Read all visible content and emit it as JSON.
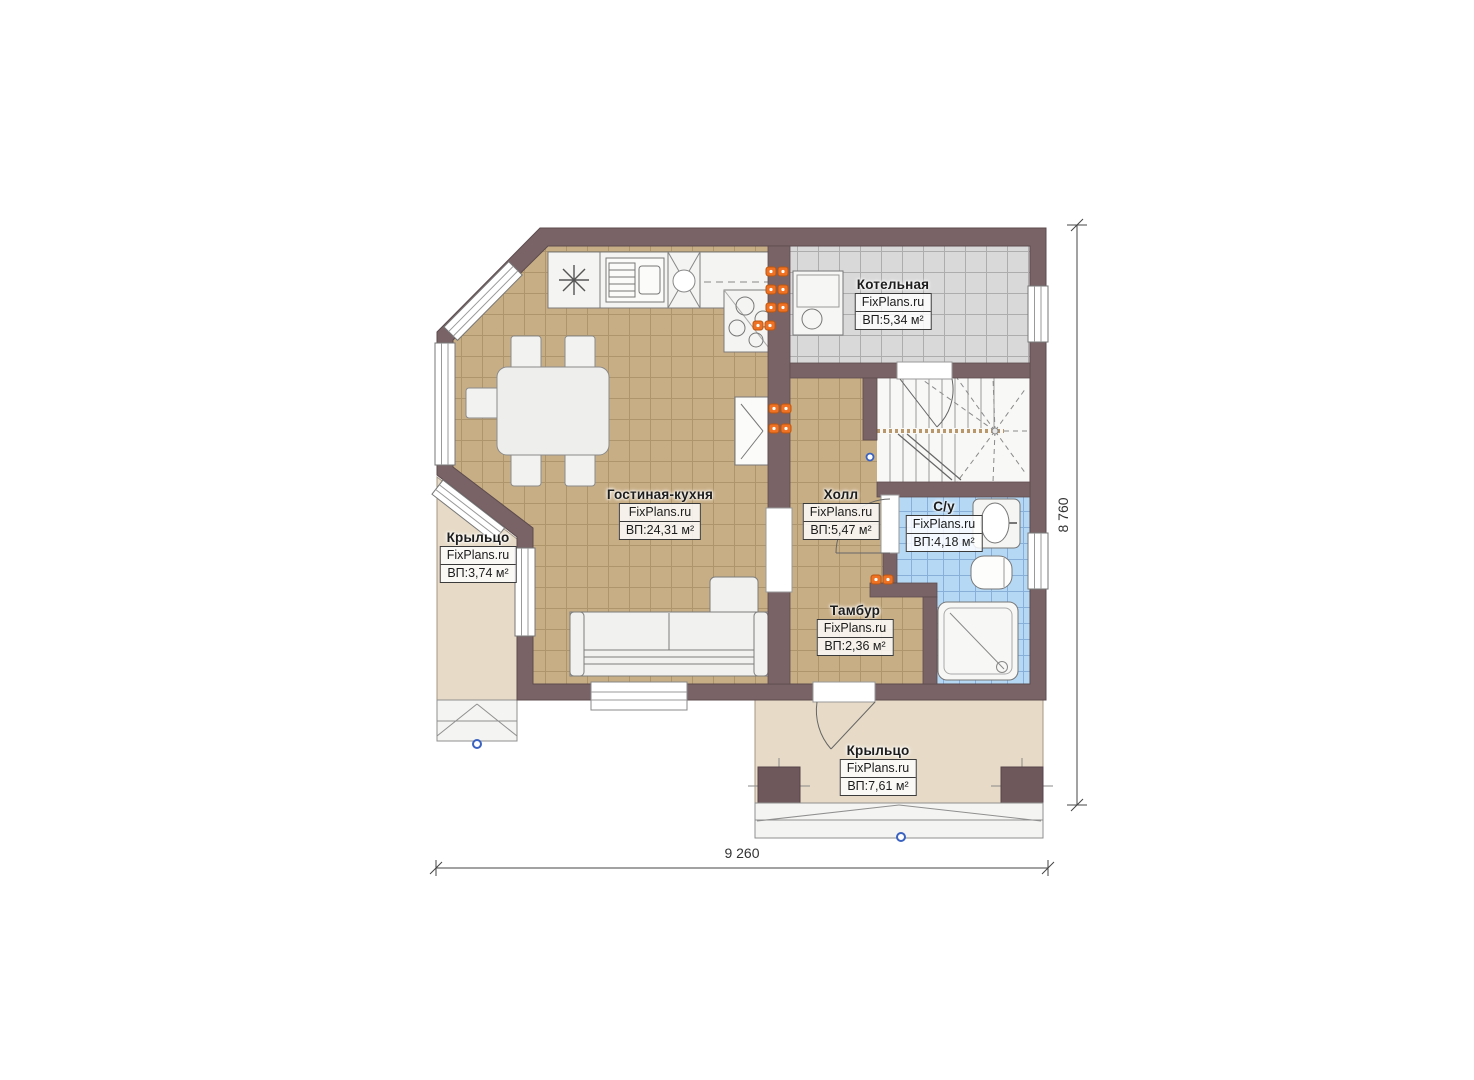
{
  "brand": "FixPlans.ru",
  "rooms": {
    "boiler": {
      "name": "Котельная",
      "brand": "FixPlans.ru",
      "area": "ВП:5,34 м²"
    },
    "living_kitchen": {
      "name": "Гостиная-кухня",
      "brand": "FixPlans.ru",
      "area": "ВП:24,31 м²"
    },
    "hall": {
      "name": "Холл",
      "brand": "FixPlans.ru",
      "area": "ВП:5,47 м²"
    },
    "bathroom": {
      "name": "С/у",
      "brand": "FixPlans.ru",
      "area": "ВП:4,18 м²"
    },
    "vestibule": {
      "name": "Тамбур",
      "brand": "FixPlans.ru",
      "area": "ВП:2,36 м²"
    },
    "porch_left": {
      "name": "Крыльцо",
      "brand": "FixPlans.ru",
      "area": "ВП:3,74 м²"
    },
    "porch_bottom": {
      "name": "Крыльцо",
      "brand": "FixPlans.ru",
      "area": "ВП:7,61 м²"
    }
  },
  "dimensions": {
    "width": "9 260",
    "height": "8 760"
  },
  "colors": {
    "wall": "#7a6367",
    "floor_living": "#c8ae85",
    "floor_boiler": "#d9d9d9",
    "floor_bath": "#b5d8f4",
    "porch": "#e7dbc7",
    "socket": "#ef7123"
  }
}
